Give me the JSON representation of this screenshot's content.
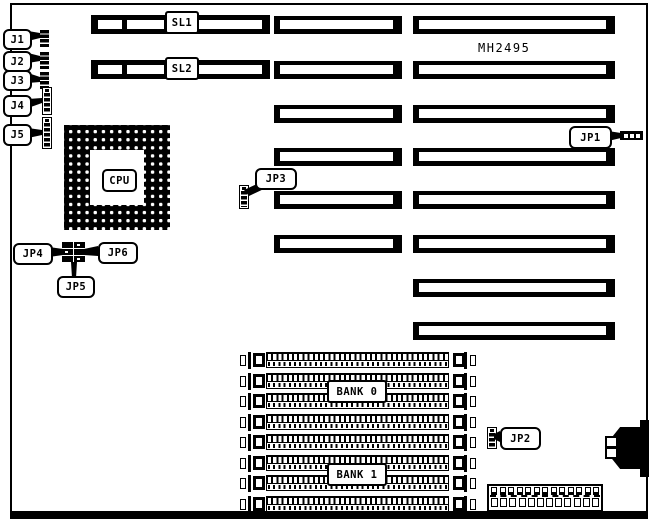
{
  "board": {
    "model_text": "MH2495"
  },
  "callouts": {
    "j1": "J1",
    "j2": "J2",
    "j3": "J3",
    "j4": "J4",
    "j5": "J5",
    "jp1": "JP1",
    "jp2": "JP2",
    "jp3": "JP3",
    "jp4": "JP4",
    "jp5": "JP5",
    "jp6": "JP6"
  },
  "slots": {
    "sl1_label": "SL1",
    "sl2_label": "SL2"
  },
  "cpu": {
    "label": "CPU"
  },
  "memory": {
    "bank0_label": "BANK 0",
    "bank1_label": "BANK 1",
    "simm_count": 8
  },
  "colors": {
    "ink": "#000000",
    "paper": "#ffffff"
  }
}
